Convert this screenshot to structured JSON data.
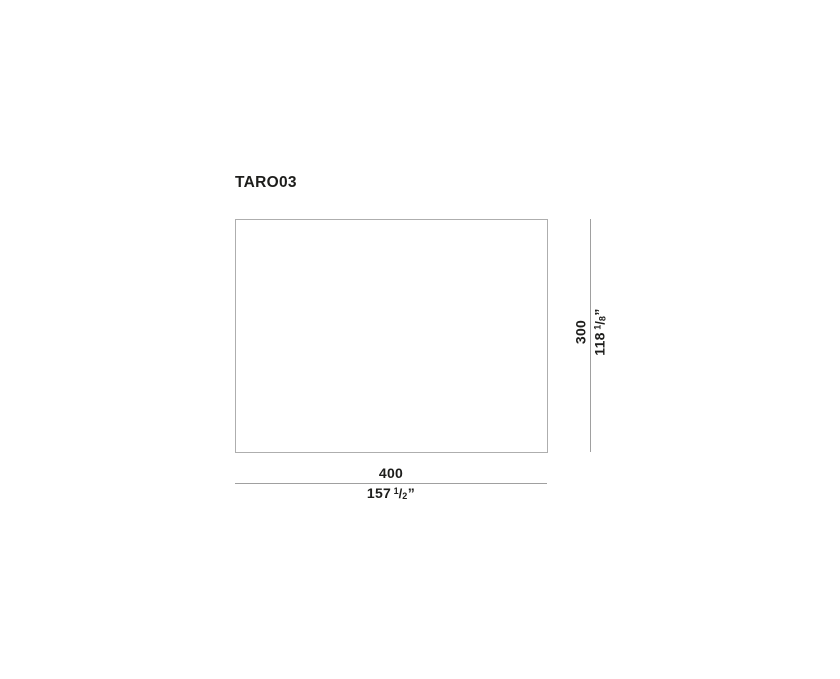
{
  "title": "TARO03",
  "drawing": {
    "width_dimension": {
      "cm": "400",
      "inches_whole": "157",
      "inches_numerator": "1",
      "fraction_slash": "/",
      "inches_denominator": "2",
      "inches_mark": "”"
    },
    "height_dimension": {
      "cm": "300",
      "inches_whole": "118",
      "inches_numerator": "1",
      "fraction_slash": "/",
      "inches_denominator": "8",
      "inches_mark": "”"
    }
  },
  "colors": {
    "text": "#1d1d1b",
    "line": "#a0a0a0",
    "outline_border": "#aeaeae",
    "background": "#ffffff"
  }
}
